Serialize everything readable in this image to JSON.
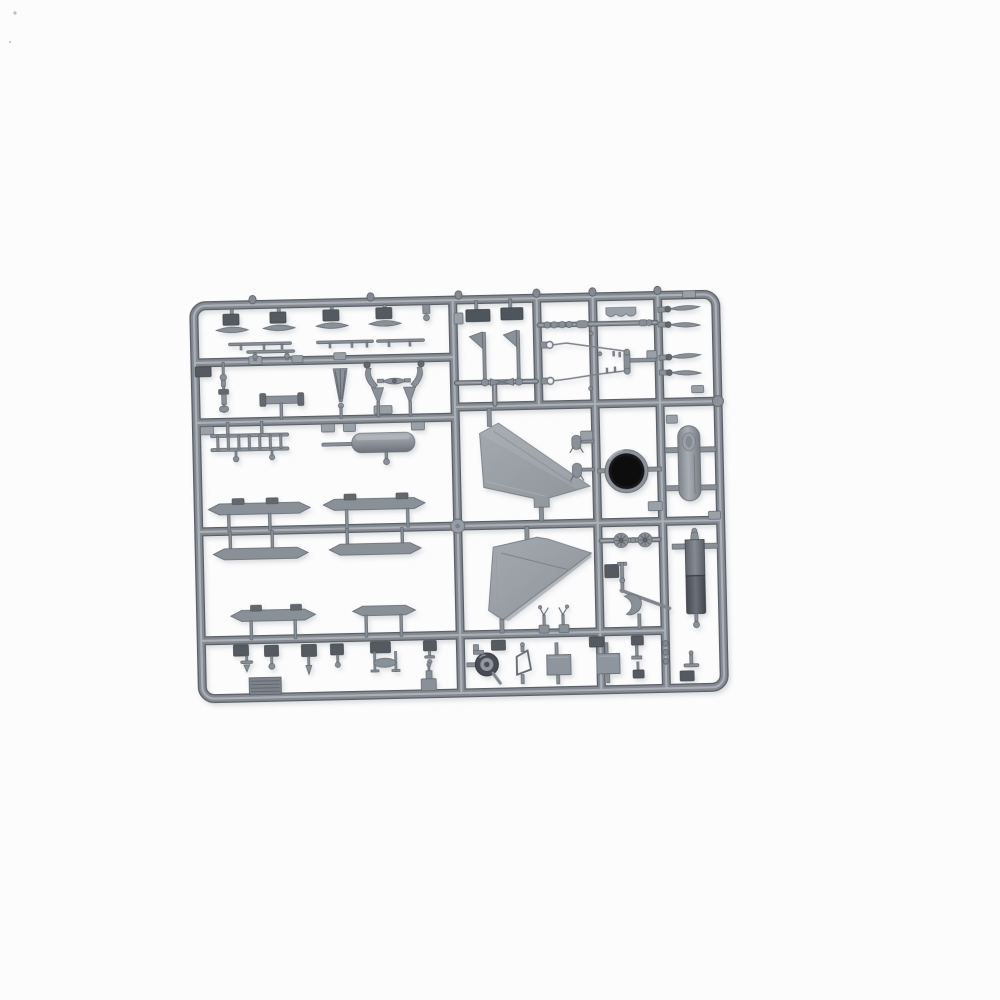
{
  "meta": {
    "type": "photograph",
    "description": "Product photo of an unassembled plastic scale-model kit sprue: a rounded rectangular grey styrene runner frame filled with small unpainted aircraft parts, lying on a plain white background.",
    "alt": "Grey plastic model kit sprue with aircraft parts on white background"
  },
  "colors": {
    "bg": "#fcfcfd",
    "runner_dark": "#5a5f66",
    "runner_mid": "#858a92",
    "runner_hi": "#b2b7bd",
    "part_light": "#9aa0a8",
    "part_mid": "#8a9097",
    "part_dark": "#62676e",
    "plate_dark": "#555a61",
    "fin_light": "#a4a9af",
    "fin_dark": "#8f949b",
    "nozzle_black": "#0b0b0d",
    "shadow": "#6a6f75"
  },
  "sprue": {
    "material": "grey injection-molded styrene",
    "frame_shape": "rounded rectangle with internal runner grid",
    "parts_inventory": [
      {
        "name": "vertical-stabilizer-half",
        "count": 2
      },
      {
        "name": "engine-exhaust-nozzle",
        "count": 1
      },
      {
        "name": "drop-tank-half",
        "count": 2
      },
      {
        "name": "missile-body-half",
        "count": 6
      },
      {
        "name": "boarding-ladder",
        "count": 1
      },
      {
        "name": "exhaust-pipe",
        "count": 1
      },
      {
        "name": "main-wheel",
        "count": 1
      },
      {
        "name": "wheel-hub-half",
        "count": 2
      },
      {
        "name": "windscreen-frame",
        "count": 1
      },
      {
        "name": "access-hatch-panel",
        "count": 2
      },
      {
        "name": "stabilator-blade",
        "count": 4
      },
      {
        "name": "antenna-rod",
        "count": 4
      },
      {
        "name": "landing-gear-strut",
        "count": 1
      },
      {
        "name": "actuator-linkage-wire",
        "count": 2
      },
      {
        "name": "wing-pylon",
        "count": 1
      },
      {
        "name": "louvered-vent-plate",
        "count": 1
      },
      {
        "name": "small-fittings-and-pins",
        "count": 30
      }
    ]
  }
}
